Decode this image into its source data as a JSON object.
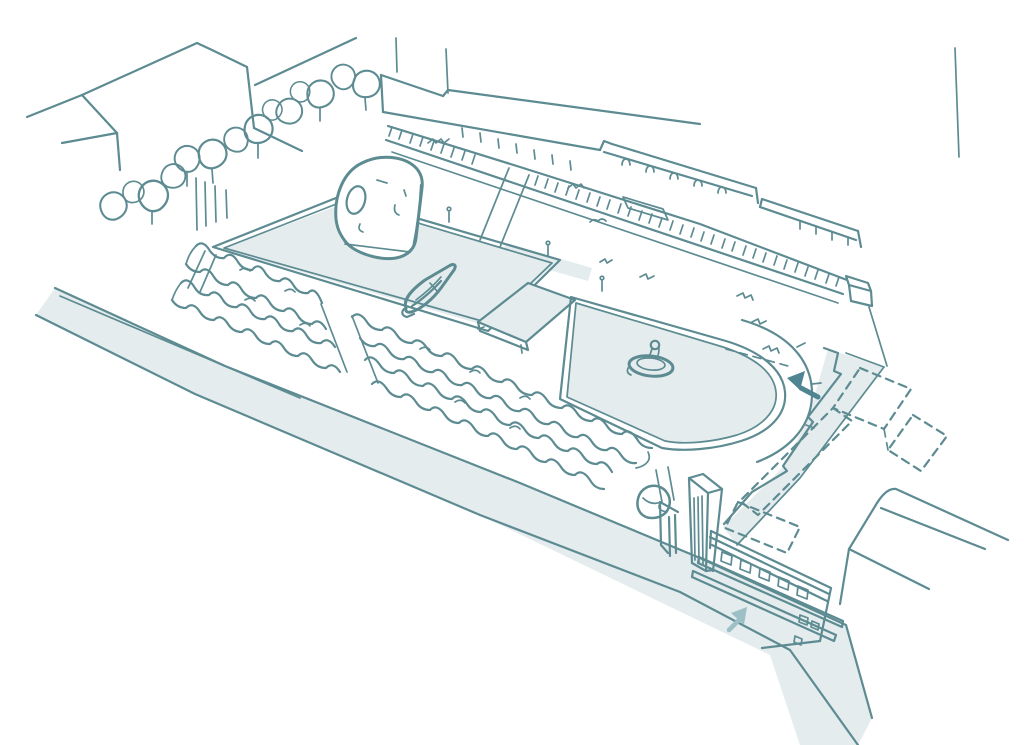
{
  "illustration": {
    "title": "Hand-drawn axonometric park site sketch",
    "style": "loose teal ink sketch on white, pale blue-grey shading",
    "elements": [
      {
        "name": "city-block-building",
        "desc": "plain roofed building block, top left"
      },
      {
        "name": "street-trees-row",
        "desc": "diagonal row of round street trees"
      },
      {
        "name": "arcade-buildings",
        "desc": "long stepped buildings with small arched windows along the upper promenade"
      },
      {
        "name": "balustrade-promenade",
        "desc": "hatched balustrade railing with end pedestal"
      },
      {
        "name": "rectangular-pond",
        "desc": "shaded boating pond"
      },
      {
        "name": "dome-pavilion",
        "desc": "egg-shaped dome structure with oval opening at pond end"
      },
      {
        "name": "model-boat",
        "desc": "small sketched boat on the pond"
      },
      {
        "name": "raised-platform",
        "desc": "low rectangular platform between the two ponds"
      },
      {
        "name": "oval-pond",
        "desc": "rounded pool with concentric walkway arcs"
      },
      {
        "name": "fountain",
        "desc": "small central fountain with finial"
      },
      {
        "name": "hedge-rows",
        "desc": "two wavy clipped hedge rows with crossing paths"
      },
      {
        "name": "clock-tower",
        "desc": "tall slender striped tower"
      },
      {
        "name": "gate-kiosk",
        "desc": "small gate structure beside tower"
      },
      {
        "name": "entrance-building",
        "desc": "low building with square windows and long steps, bottom right"
      },
      {
        "name": "phantom-buildings",
        "desc": "dashed outlines of proposed buildings, right side"
      },
      {
        "name": "riverside-road",
        "desc": "wide shaded diagonal road, lower left"
      },
      {
        "name": "side-road",
        "desc": "narrow shaded road along the park's right edge"
      },
      {
        "name": "bridge-road",
        "desc": "forked road lines, far bottom right"
      },
      {
        "name": "direction-arrow-upper",
        "desc": "solid teal arrow pointing up-left"
      },
      {
        "name": "direction-arrow-lower",
        "desc": "pale teal arrow pointing up-right"
      }
    ]
  },
  "colors": {
    "background": "#ffffff",
    "line": "#5d8b92",
    "line_soft": "#8fb3b8",
    "shade": "#e4ecee",
    "arrow": "#4e8591",
    "arrow_soft": "#9cc0c5"
  }
}
